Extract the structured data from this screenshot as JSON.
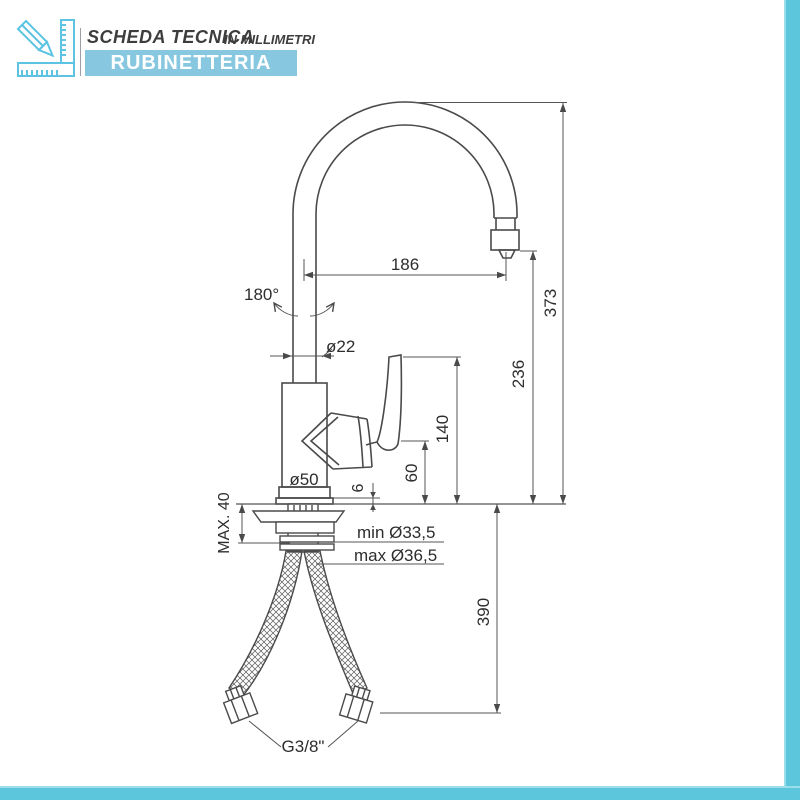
{
  "header": {
    "title": "SCHEDA TECNICA",
    "subtitle": "IN MILLIMETRI",
    "banner": "RUBINETTERIA"
  },
  "colors": {
    "banner_blue": "#87c8e0",
    "frame_teal": "#5bc6dc",
    "icon_cyan": "#5cc3e2",
    "drawing_line": "#4a4a4a"
  },
  "drawing": {
    "subject": "single-lever kitchen mixer tap with swivel gooseneck spout and flexible hoses",
    "unit": "mm",
    "dims": {
      "spout_reach": "186",
      "overall_height": "373",
      "outlet_clearance": "236",
      "handle_top_height": "140",
      "handle_bottom_height": "60",
      "base_plate_gap": "6",
      "spout_tube_diameter": "ø22",
      "swivel_angle": "180°",
      "base_diameter": "ø50",
      "max_deck_thickness": "MAX. 40",
      "hole_min_diameter": "min Ø33,5",
      "hole_max_diameter": "max Ø36,5",
      "hose_drop_length": "390",
      "hose_thread": "G3/8\""
    }
  }
}
